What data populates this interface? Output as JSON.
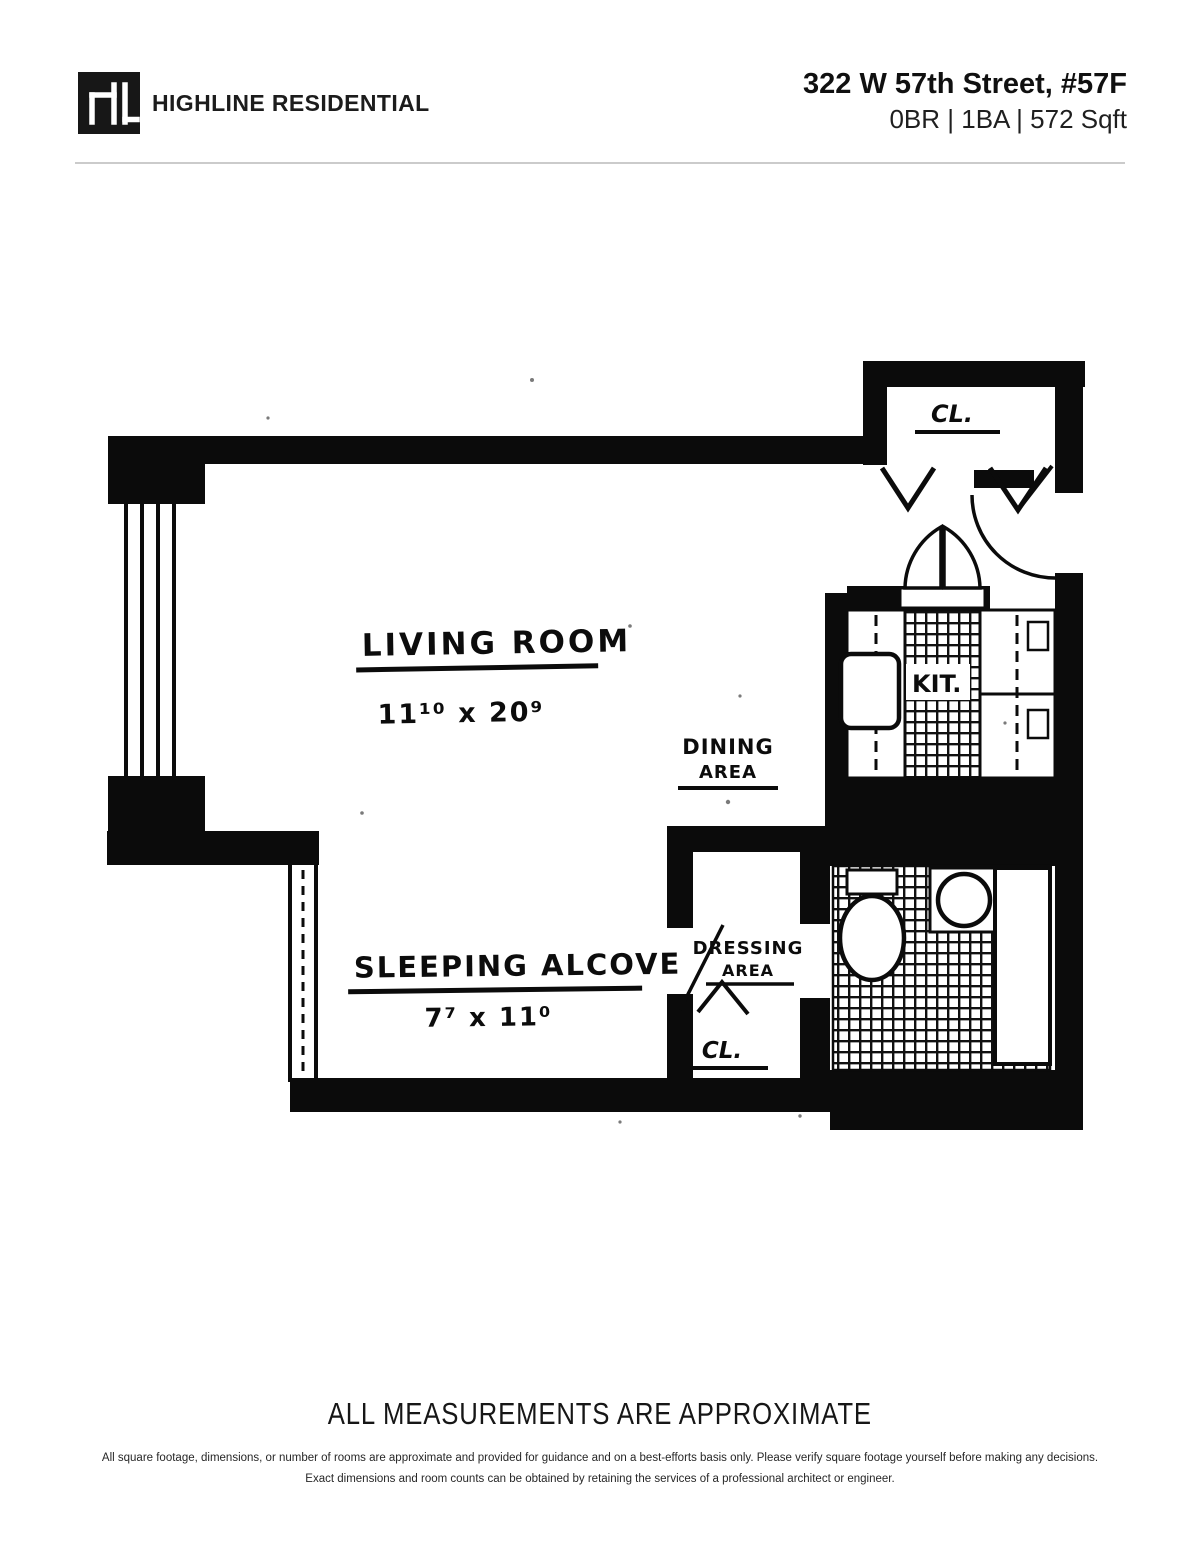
{
  "header": {
    "logo_icon": "hl-monogram",
    "brand": "HIGHLINE RESIDENTIAL",
    "address": "322 W 57th Street, #57F",
    "specs": "0BR | 1BA | 572 Sqft"
  },
  "floorplan": {
    "rooms": {
      "living_room": {
        "label": "LIVING ROOM",
        "dims": "11¹⁰ x 20⁹"
      },
      "dining_area": {
        "line1": "DINING",
        "line2": "AREA"
      },
      "kitchen": {
        "label": "KIT."
      },
      "sleeping_alcove": {
        "label": "SLEEPING ALCOVE",
        "dims": "7⁷ x 11⁰"
      },
      "dressing_area": {
        "line1": "DRESSING",
        "line2": "AREA"
      },
      "closet_top": {
        "label": "CL."
      },
      "closet_bottom": {
        "label": "CL."
      }
    }
  },
  "footer": {
    "measurements_note": "ALL MEASUREMENTS ARE APPROXIMATE",
    "disclaimer": "All square footage, dimensions, or number of rooms are approximate and provided for guidance and on a best-efforts basis only. Please verify square footage yourself before making any decisions. Exact dimensions and room counts can be obtained by retaining the services of a professional architect or engineer."
  },
  "colors": {
    "ink": "#111111",
    "divider": "#cccccc"
  }
}
